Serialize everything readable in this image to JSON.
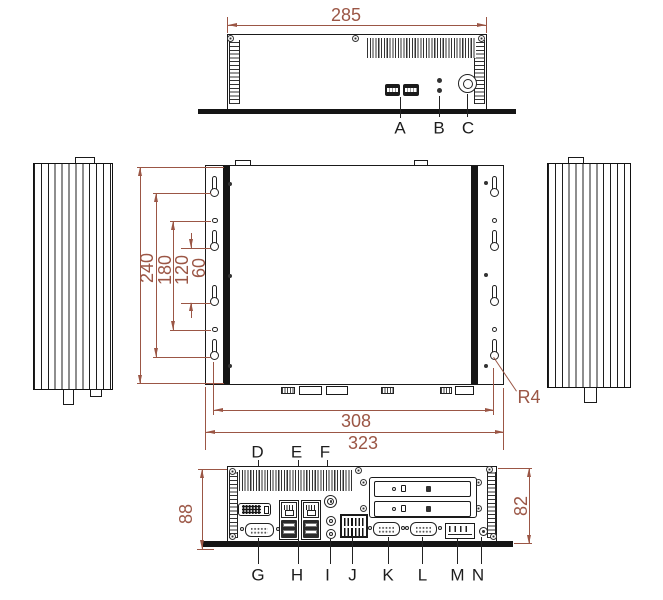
{
  "colors": {
    "dimension_accent": "#9b5645",
    "line": "#1a1a1a",
    "label": "#1d1d1d",
    "background": "#ffffff"
  },
  "front_view": {
    "width_dim": "285",
    "callouts": {
      "a": "A",
      "b": "B",
      "c": "C"
    }
  },
  "top_view": {
    "height_dim": "240",
    "outer_hole_dim": "180",
    "mid_hole_dim": "120",
    "inner_hole_dim": "60",
    "mount_width_dim": "308",
    "overall_width_dim": "323",
    "corner_radius_dim": "R4"
  },
  "rear_view": {
    "overall_height_dim": "88",
    "body_height_dim": "82",
    "callouts": {
      "d": "D",
      "e": "E",
      "f": "F",
      "g": "G",
      "h": "H",
      "i": "I",
      "j": "J",
      "k": "K",
      "l": "L",
      "m": "M",
      "n": "N"
    }
  }
}
